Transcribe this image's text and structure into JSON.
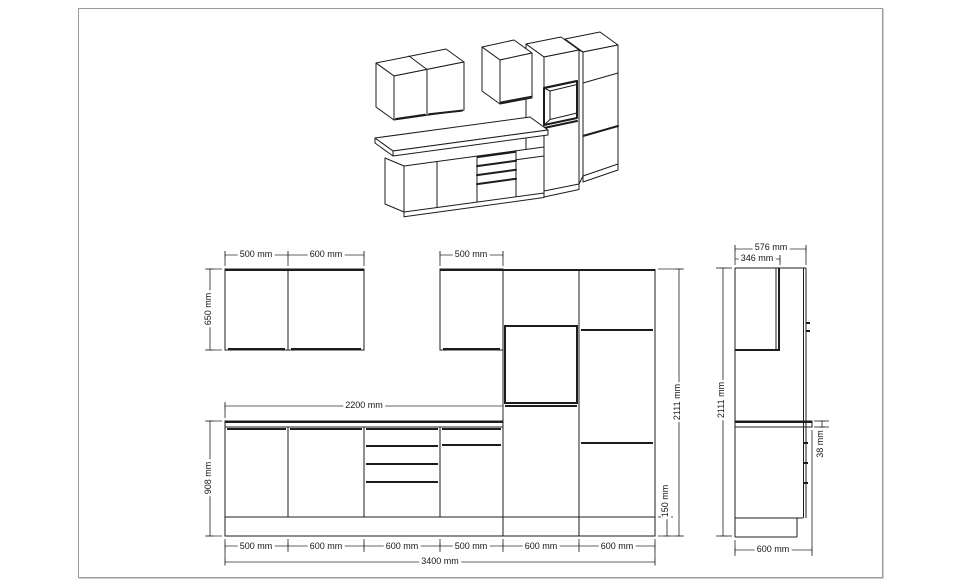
{
  "front_elevation": {
    "wall_dims": [
      "500 mm",
      "600 mm",
      "500 mm"
    ],
    "wall_height_dim": "650 mm",
    "base_height_dim": "908 mm",
    "counter_dim": "2200 mm",
    "plinth_dim": "150 mm",
    "total_height_dim": "2111 mm",
    "bottom_dims": [
      "500 mm",
      "600 mm",
      "600 mm",
      "500 mm",
      "600 mm",
      "600 mm"
    ],
    "total_width_dim": "3400 mm"
  },
  "side_view": {
    "depth_dim": "576 mm",
    "wall_cabinet_depth_dim": "346 mm",
    "height_dim": "2111 mm",
    "counter_thickness_dim": "38 mm",
    "base_depth_dim": "600 mm"
  }
}
